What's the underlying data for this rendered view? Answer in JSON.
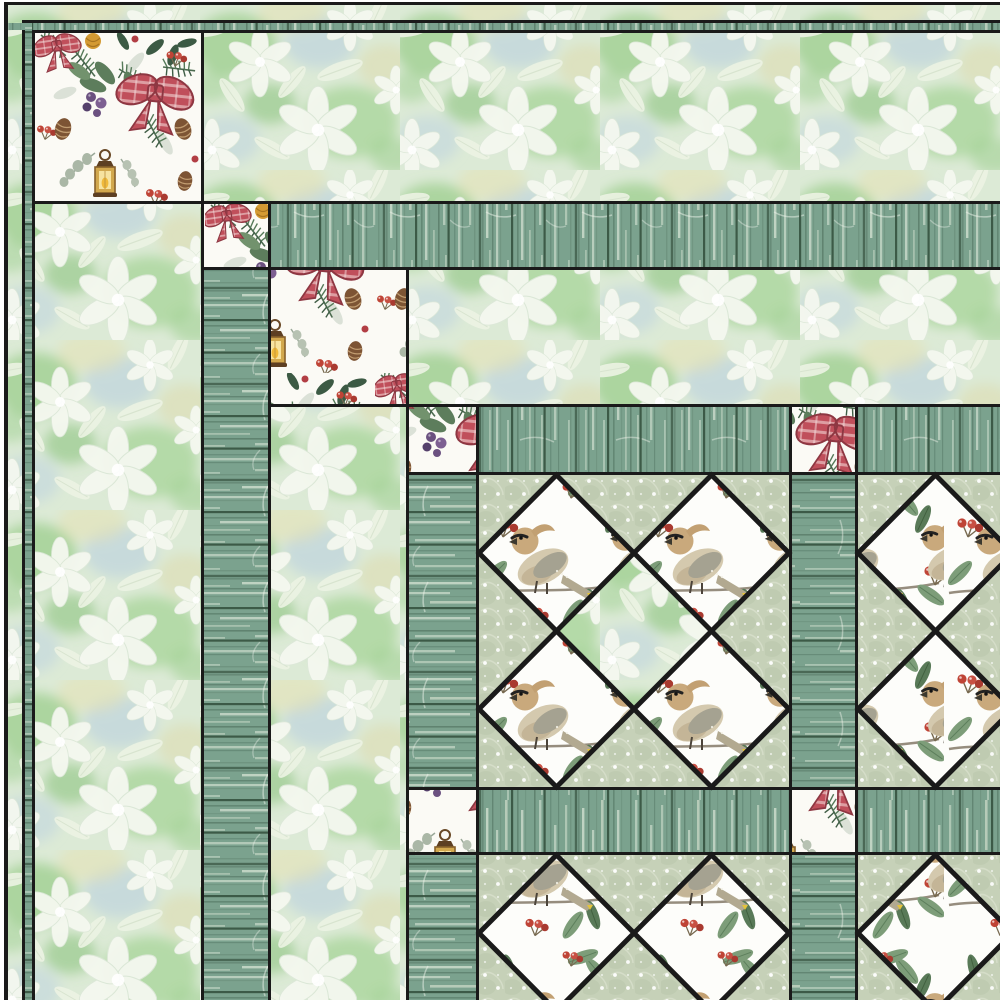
{
  "meta": {
    "alt": "Quilt pattern mockup with nested borders of white floral watercolor fabric and teal barnwood plank fabric, Christmas wreath corner blocks with red plaid bows and lanterns, and on-point diamond blocks of cedar waxwing bird and red berry print on a sage polka dot background"
  },
  "canvas": {
    "w": 1000,
    "h": 1000
  },
  "palette": {
    "frame": "#1a1a1a",
    "margin_white": "#ffffff",
    "floral_base": "#dcead6",
    "wood_base": "#7ba28e",
    "wood_dark": "#35523f",
    "wood_light": "#d5e3d3",
    "dots_base": "#c6d1b8",
    "print_bg": "#fbfaf5",
    "bow_red": "#c04f5b",
    "berry_red": "#bf4436",
    "leaf_green": "#5d7d5c",
    "lantern_gold": "#d2a84e",
    "bird_tan": "#c9a97c"
  },
  "fabrics": [
    {
      "id": "floral",
      "label": "white floral watercolor on green"
    },
    {
      "id": "wood",
      "label": "teal barnwood planks (vertical grain)"
    },
    {
      "id": "wood-h",
      "label": "teal barnwood planks (horizontal grain)"
    },
    {
      "id": "dots",
      "label": "sage snow-dot"
    },
    {
      "id": "wreath",
      "label": "Christmas wreath print with plaid bows, pinecones, lantern"
    },
    {
      "id": "bird",
      "label": "cedar waxwing bird and winterberry print"
    }
  ],
  "quilt": {
    "fabric_patterns": {
      "floral": "pat-floral",
      "wood": "pat-wood",
      "wood-h": "pat-wood-h",
      "dots": "pat-dots",
      "wreath": "pat-wreath",
      "bird": "pat-bird"
    },
    "frame_stroke": 5,
    "pieces": [
      {
        "name": "outer-frame",
        "fill": "frame",
        "x": 4,
        "y": 2,
        "w": 996,
        "h": 998
      },
      {
        "name": "outer-border-floral-top",
        "fabric": "floral",
        "x": 8,
        "y": 5,
        "w": 992,
        "h": 15
      },
      {
        "name": "outer-border-floral-left",
        "fabric": "floral",
        "x": 8,
        "y": 5,
        "w": 14,
        "h": 995
      },
      {
        "name": "outer-border-wood-top",
        "fabric": "wood",
        "x": 8,
        "y": 23,
        "w": 992,
        "h": 7
      },
      {
        "name": "outer-border-wood-left",
        "fabric": "wood-h",
        "x": 25,
        "y": 23,
        "w": 7,
        "h": 977
      },
      {
        "name": "corner-block-1",
        "fabric": "wreath",
        "x": 35,
        "y": 33,
        "w": 166,
        "h": 168
      },
      {
        "name": "border-floral-top-1",
        "fabric": "floral",
        "x": 204,
        "y": 33,
        "w": 796,
        "h": 168
      },
      {
        "name": "border-floral-left-1",
        "fabric": "floral",
        "x": 35,
        "y": 204,
        "w": 166,
        "h": 796
      },
      {
        "name": "corner-block-2",
        "fabric": "wreath",
        "x": 204,
        "y": 204,
        "w": 64,
        "h": 63
      },
      {
        "name": "border-wood-top-1",
        "fabric": "wood",
        "x": 271,
        "y": 204,
        "w": 729,
        "h": 63
      },
      {
        "name": "border-wood-left-1",
        "fabric": "wood-h",
        "x": 204,
        "y": 270,
        "w": 64,
        "h": 730
      },
      {
        "name": "corner-block-3",
        "fabric": "wreath",
        "x": 271,
        "y": 270,
        "w": 135,
        "h": 134
      },
      {
        "name": "border-floral-top-2",
        "fabric": "floral",
        "x": 409,
        "y": 270,
        "w": 591,
        "h": 134
      },
      {
        "name": "border-floral-left-2",
        "fabric": "floral",
        "x": 271,
        "y": 407,
        "w": 135,
        "h": 593
      },
      {
        "name": "corner-block-4",
        "fabric": "wreath",
        "x": 409,
        "y": 407,
        "w": 67,
        "h": 65
      },
      {
        "name": "border-wood-top-2-left",
        "fabric": "wood",
        "x": 479,
        "y": 407,
        "w": 310,
        "h": 65
      },
      {
        "name": "cornerstone-top-right",
        "fabric": "wreath",
        "x": 792,
        "y": 407,
        "w": 63,
        "h": 65
      },
      {
        "name": "border-wood-top-2-right",
        "fabric": "wood",
        "x": 858,
        "y": 407,
        "w": 142,
        "h": 65
      },
      {
        "name": "border-wood-left-2-upper",
        "fabric": "wood-h",
        "x": 409,
        "y": 475,
        "w": 67,
        "h": 312
      },
      {
        "name": "cornerstone-bottom-left",
        "fabric": "wreath",
        "x": 409,
        "y": 790,
        "w": 67,
        "h": 62
      },
      {
        "name": "border-wood-left-2-lower",
        "fabric": "wood-h",
        "x": 409,
        "y": 855,
        "w": 67,
        "h": 145
      },
      {
        "name": "block-background-r1-c1",
        "fabric": "dots",
        "x": 479,
        "y": 475,
        "w": 310,
        "h": 312
      },
      {
        "name": "block-background-r1-c2",
        "fabric": "dots",
        "x": 858,
        "y": 475,
        "w": 142,
        "h": 312
      },
      {
        "name": "block-background-r2-c1",
        "fabric": "dots",
        "x": 479,
        "y": 855,
        "w": 310,
        "h": 145
      },
      {
        "name": "block-background-r2-c2",
        "fabric": "dots",
        "x": 858,
        "y": 855,
        "w": 142,
        "h": 145
      },
      {
        "name": "sashing-vertical-upper",
        "fabric": "wood-h",
        "x": 792,
        "y": 475,
        "w": 63,
        "h": 312
      },
      {
        "name": "sashing-horizontal-left",
        "fabric": "wood",
        "x": 479,
        "y": 790,
        "w": 310,
        "h": 62
      },
      {
        "name": "sashing-cornerstone",
        "fabric": "wreath",
        "x": 792,
        "y": 790,
        "w": 63,
        "h": 62
      },
      {
        "name": "sashing-horizontal-right",
        "fabric": "wood",
        "x": 858,
        "y": 790,
        "w": 142,
        "h": 62
      },
      {
        "name": "sashing-vertical-lower",
        "fabric": "wood-h",
        "x": 792,
        "y": 855,
        "w": 63,
        "h": 145
      }
    ],
    "setting_squares": [
      {
        "name": "setting-square-center-r1c1",
        "fabric": "floral",
        "cx": 634,
        "cy": 631,
        "rx": 78,
        "ry": 79
      }
    ],
    "diamonds": [
      {
        "name": "bird-diamond-r1c1-a",
        "cx": 556.5,
        "cy": 553,
        "rx": 77.5,
        "ry": 78
      },
      {
        "name": "bird-diamond-r1c1-b",
        "cx": 711.5,
        "cy": 553,
        "rx": 77.5,
        "ry": 78
      },
      {
        "name": "bird-diamond-r1c1-c",
        "cx": 556.5,
        "cy": 709,
        "rx": 77.5,
        "ry": 78
      },
      {
        "name": "bird-diamond-r1c1-d",
        "cx": 711.5,
        "cy": 709,
        "rx": 77.5,
        "ry": 78
      },
      {
        "name": "bird-diamond-r1c2-a",
        "cx": 935.5,
        "cy": 553,
        "rx": 77.5,
        "ry": 78
      },
      {
        "name": "bird-diamond-r1c2-b",
        "cx": 935.5,
        "cy": 709,
        "rx": 77.5,
        "ry": 78
      },
      {
        "name": "bird-diamond-r2c1-a",
        "cx": 556.5,
        "cy": 933,
        "rx": 77.5,
        "ry": 78
      },
      {
        "name": "bird-diamond-r2c1-b",
        "cx": 711.5,
        "cy": 933,
        "rx": 77.5,
        "ry": 78
      },
      {
        "name": "bird-diamond-r2c2-a",
        "cx": 935.5,
        "cy": 933,
        "rx": 77.5,
        "ry": 78
      }
    ]
  }
}
